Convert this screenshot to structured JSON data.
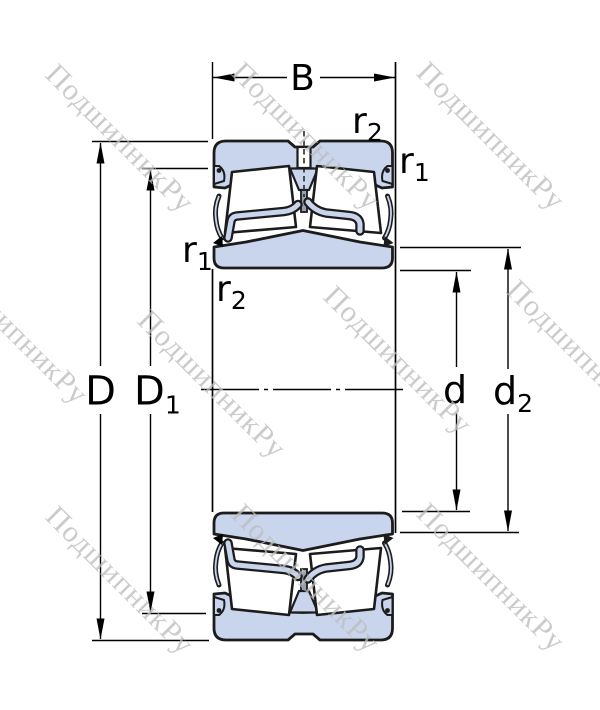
{
  "title": "Spherical roller bearing cross-section drawing",
  "watermark": {
    "text": "ПодшипникРу"
  },
  "dimensions": {
    "B": "B",
    "D": "D",
    "D1": {
      "base": "D",
      "sub": "1"
    },
    "d": "d",
    "d2": {
      "base": "d",
      "sub": "2"
    },
    "r1": {
      "base": "r",
      "sub": "1"
    },
    "r2": {
      "base": "r",
      "sub": "2"
    }
  },
  "colors": {
    "background": "#ffffff",
    "ring_fill": "#c8d5ec",
    "roller_fill": "#ffffff",
    "guide_ring_stem": "#98a1b1",
    "outline": "#1c1c1c",
    "dimension_lines": "#000000",
    "watermark": "#bdbdbd"
  }
}
